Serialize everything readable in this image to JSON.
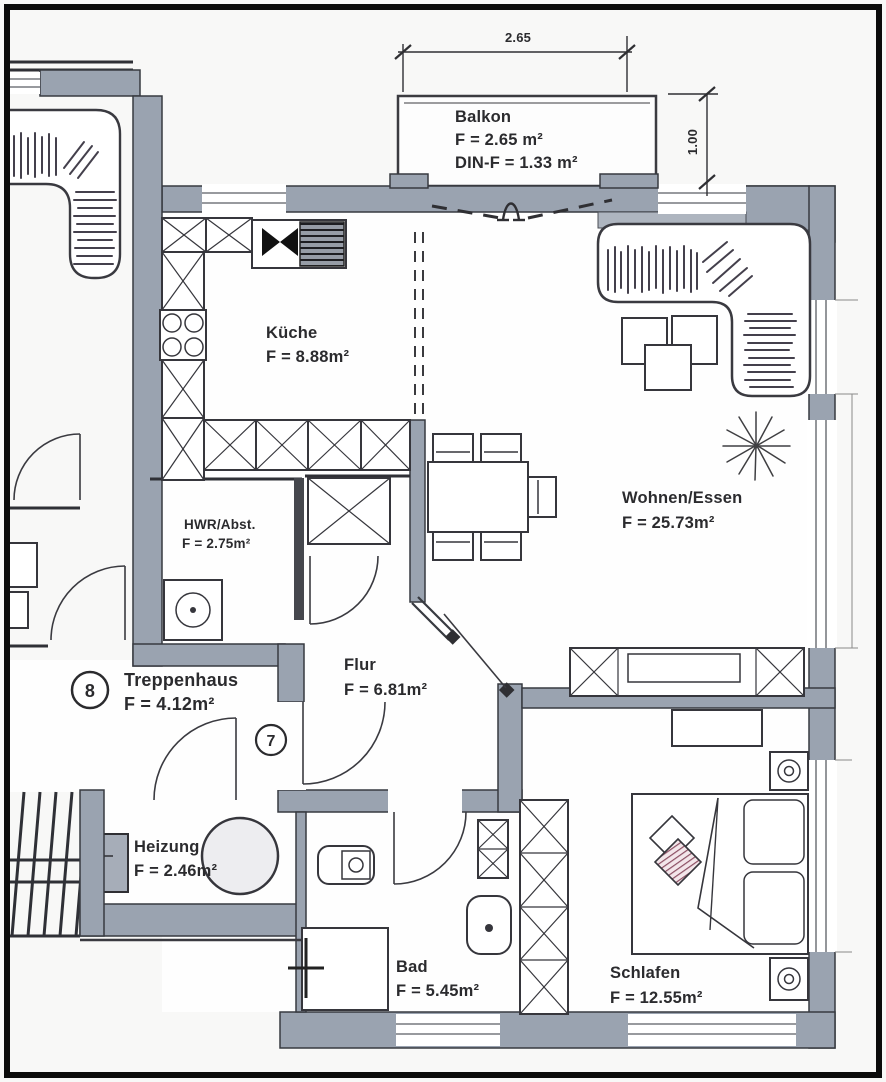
{
  "plan": {
    "rooms": {
      "balkon": {
        "name": "Balkon",
        "area": "F = 2.65 m²",
        "din": "DIN-F = 1.33 m²"
      },
      "kueche": {
        "name": "Küche",
        "area": "F = 8.88m²"
      },
      "wohnen": {
        "name": "Wohnen/Essen",
        "area": "F = 25.73m²"
      },
      "hwr": {
        "name": "HWR/Abst.",
        "area": "F = 2.75m²"
      },
      "treppenhaus": {
        "name": "Treppenhaus",
        "area": "F = 4.12m²"
      },
      "flur": {
        "name": "Flur",
        "area": "F = 6.81m²"
      },
      "heizung": {
        "name": "Heizung",
        "area": "F = 2.46m²"
      },
      "bad": {
        "name": "Bad",
        "area": "F = 5.45m²"
      },
      "schlafen": {
        "name": "Schlafen",
        "area": "F = 12.55m²"
      }
    },
    "dimensions": {
      "balcony_width": "2.65",
      "balcony_depth": "1.00"
    },
    "unit_markers": {
      "left": "8",
      "right": "7"
    },
    "colors": {
      "wall": "#9aa3b0",
      "line": "#2f2f33",
      "accent_pillow": "#8c4f63"
    }
  }
}
